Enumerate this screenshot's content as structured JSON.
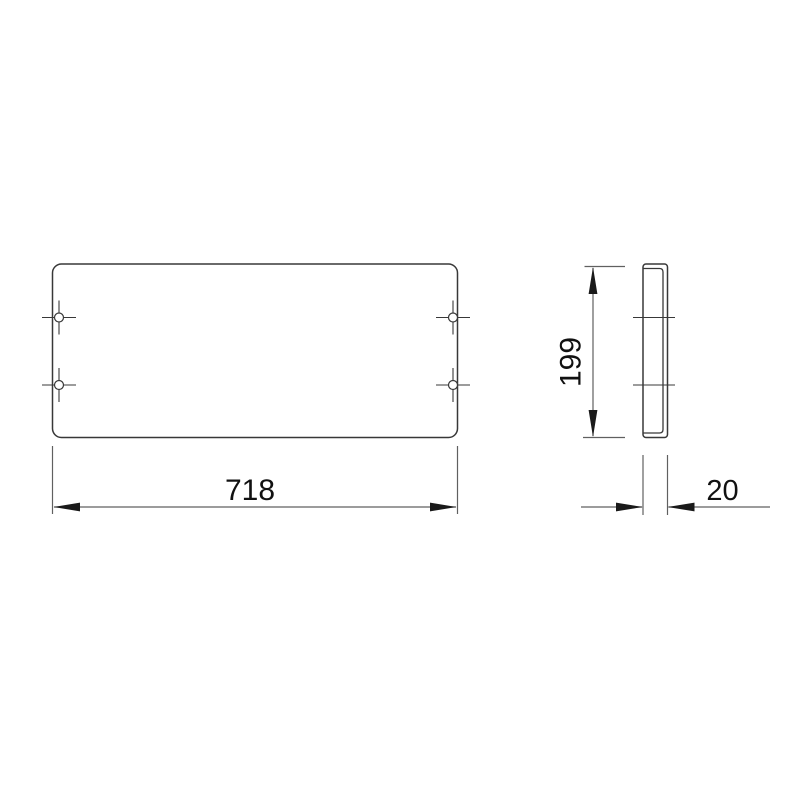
{
  "drawing": {
    "dimensions": {
      "front_width": "718",
      "side_height": "199",
      "side_depth": "20"
    }
  },
  "colors": {
    "background_color": "#ffffff",
    "outline_color": "#383838",
    "dimension_color": "#606060",
    "arrow_color": "#1a1a1a",
    "text_color": "#111111"
  }
}
